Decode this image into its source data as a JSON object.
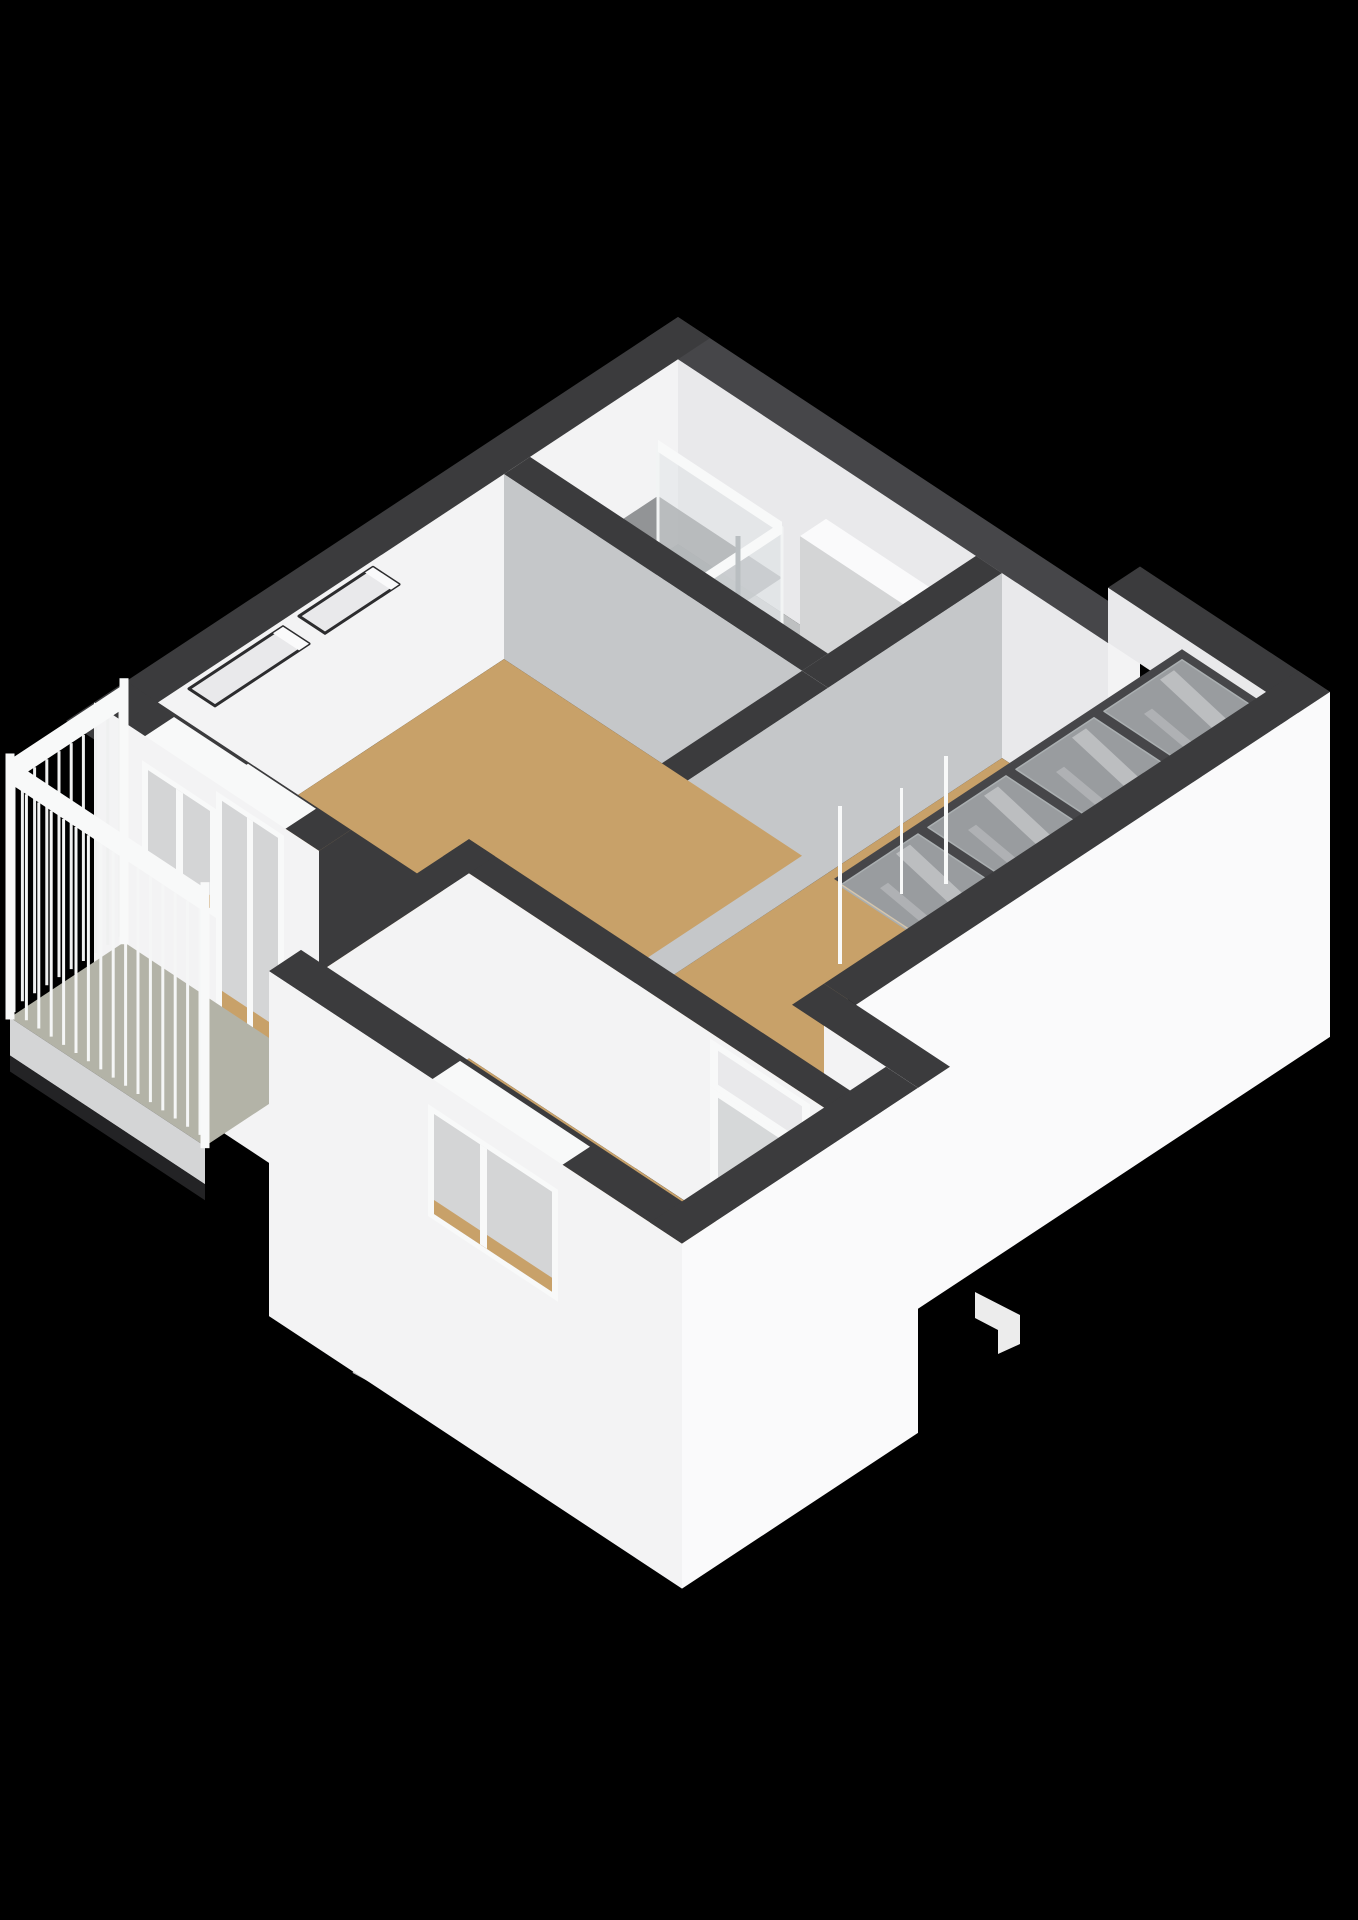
{
  "scene": {
    "title": "3d-floorplan-axonometric-render",
    "background": "#000000",
    "style": "white-model-render",
    "view": "isometric-top"
  },
  "palette": {
    "background": "#000000",
    "wallTop": "#3b3b3d",
    "wallTopLight": "#464649",
    "faceWhite": "#f3f3f4",
    "faceBright": "#fafafb",
    "faceLight": "#e9e9eb",
    "faceMid": "#d4d5d6",
    "faceGray": "#c5c7c9",
    "floorTan": "#c8a169",
    "floorBath": "#bec0c1",
    "floorBalcony": "#b3b3a7",
    "stairShaft": "#6f7073",
    "glass": "#dfe4e6",
    "frameWhite": "#f8f9f9",
    "doorGray": "#d6d8d9",
    "chrome": "#c3c8ca",
    "chromeDark": "#8a9094",
    "shadow": "#232325",
    "showerInterior": "#808285"
  },
  "rooms": [
    {
      "id": "bathroom",
      "floor": "gray"
    },
    {
      "id": "living-room",
      "floor": "tan"
    },
    {
      "id": "hallway",
      "floor": "tan"
    },
    {
      "id": "bedroom",
      "floor": "tan"
    },
    {
      "id": "stairwell",
      "floor": "glass-covered"
    },
    {
      "id": "balcony",
      "floor": "green-gray"
    }
  ],
  "fixtures": [
    "shower-cabin",
    "shower-head",
    "radiator",
    "stair-glass-panels",
    "stair-treads",
    "balustrade-spindles",
    "interior-door",
    "transom-window",
    "door-handle",
    "living-room-window",
    "balcony-door",
    "bedroom-window",
    "balcony-railing",
    "wall-niche",
    "wall-niche-2",
    "vent-panel"
  ]
}
